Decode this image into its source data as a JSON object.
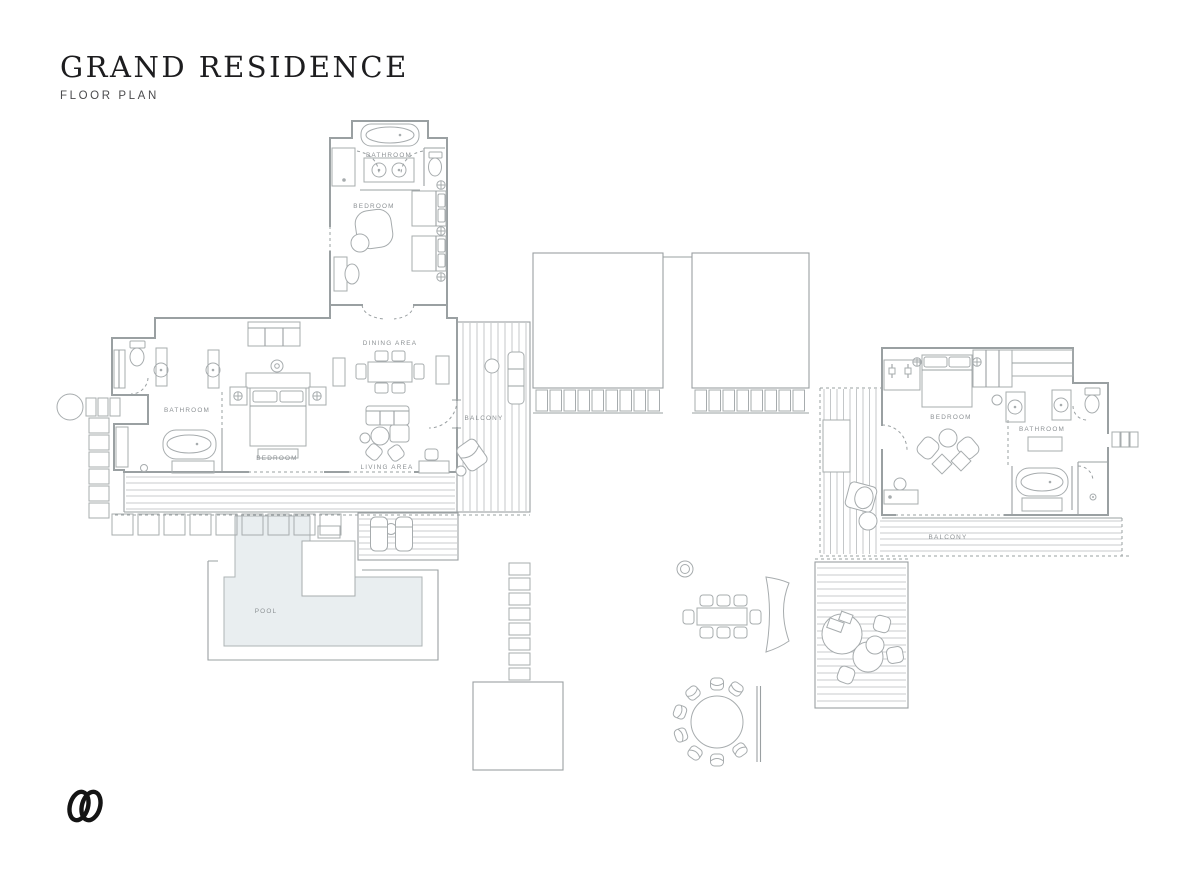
{
  "header": {
    "title": "GRAND RESIDENCE",
    "subtitle": "FLOOR PLAN"
  },
  "plan": {
    "labels": {
      "upper_bathroom": "BATHROOM",
      "upper_bedroom": "BEDROOM",
      "master_bathroom": "BATHROOM",
      "master_bedroom": "BEDROOM",
      "dining_area": "DINING AREA",
      "living_area": "LIVING AREA",
      "balcony_left": "BALCONY",
      "guest_bedroom": "BEDROOM",
      "guest_bathroom": "BATHROOM",
      "balcony_right": "BALCONY",
      "pool": "POOL"
    },
    "colors": {
      "wall": "#9aa0a2",
      "furniture": "#a7acae",
      "deck": "#b6babc",
      "label": "#8c9194",
      "pool_fill": "#e9eef0",
      "title": "#1d1d1f",
      "subtitle": "#4b4b4d",
      "logo": "#141414"
    }
  },
  "footer": {
    "logo_icon": "interlocking-double-o-monogram"
  }
}
